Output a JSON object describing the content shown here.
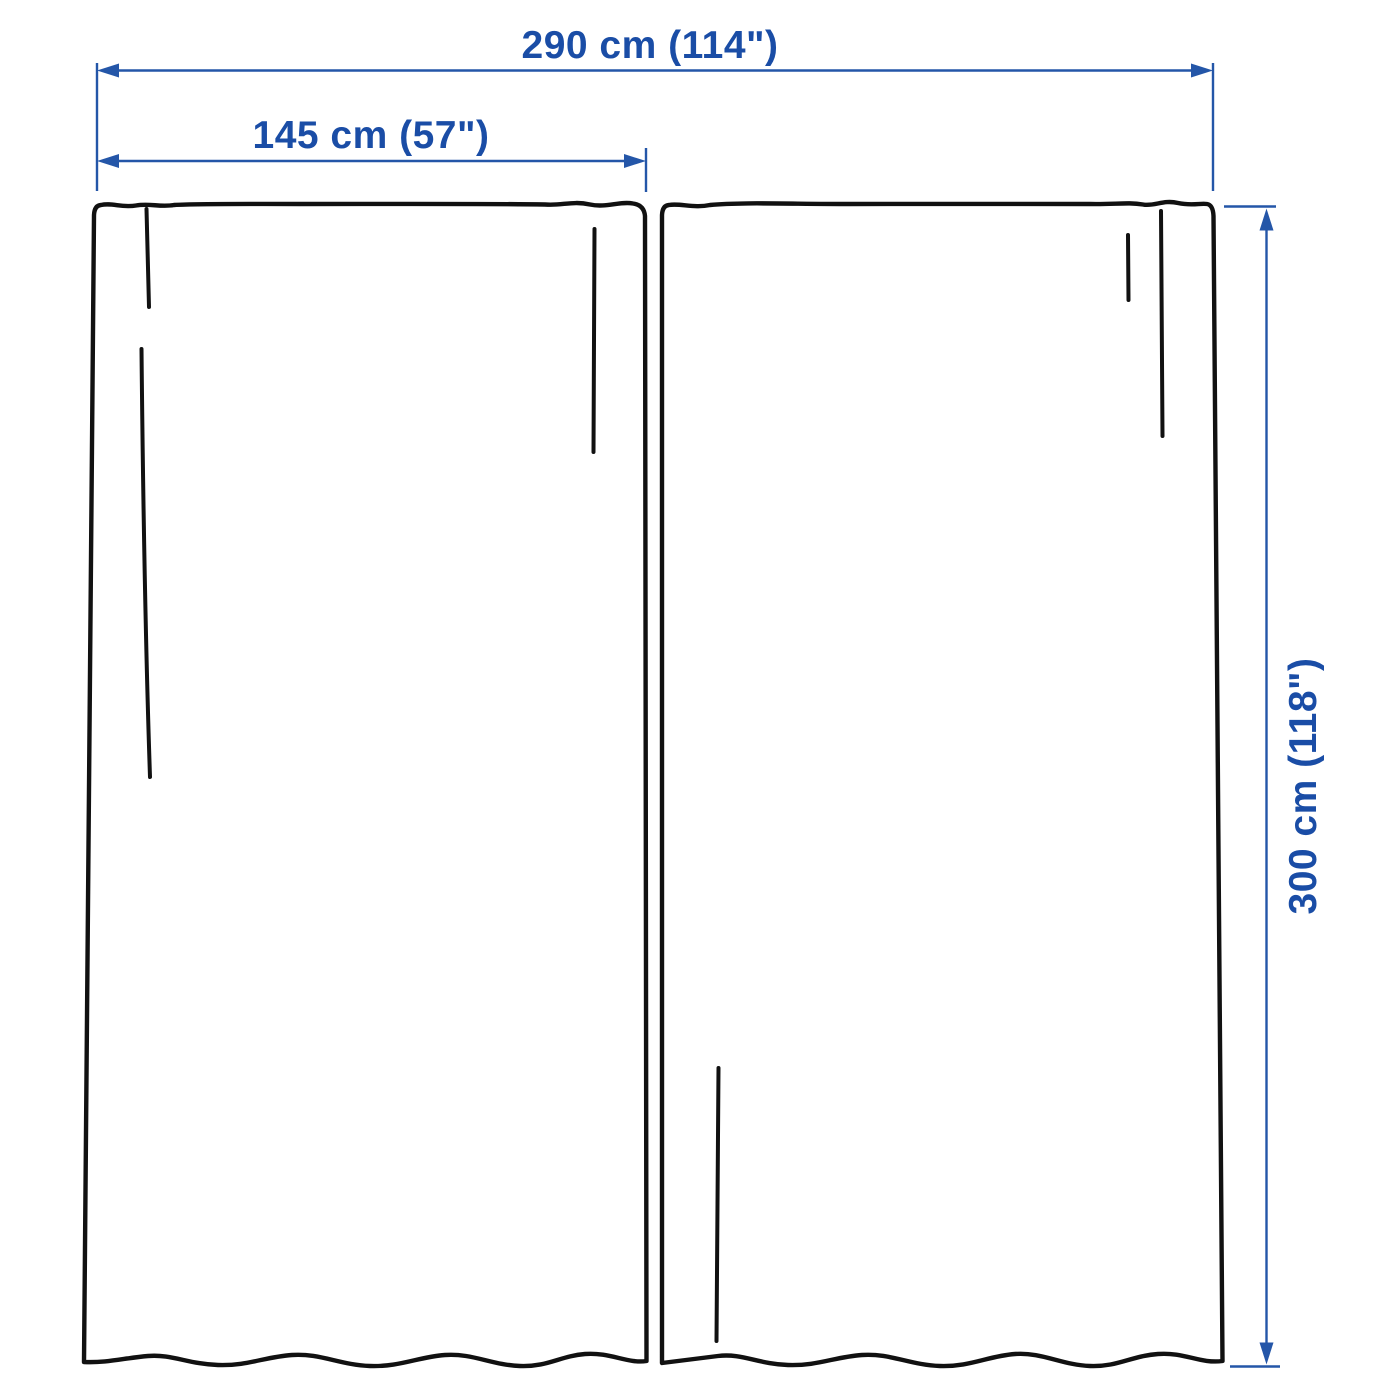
{
  "colors": {
    "background": "#ffffff",
    "outline_black": "#111111",
    "dimension_blue": "#2456a8",
    "text_blue": "#1a4da6"
  },
  "dimensions": {
    "total_width_label": "290 cm (114\")",
    "panel_width_label": "145 cm (57\")",
    "height_label": "300 cm (118\")"
  }
}
